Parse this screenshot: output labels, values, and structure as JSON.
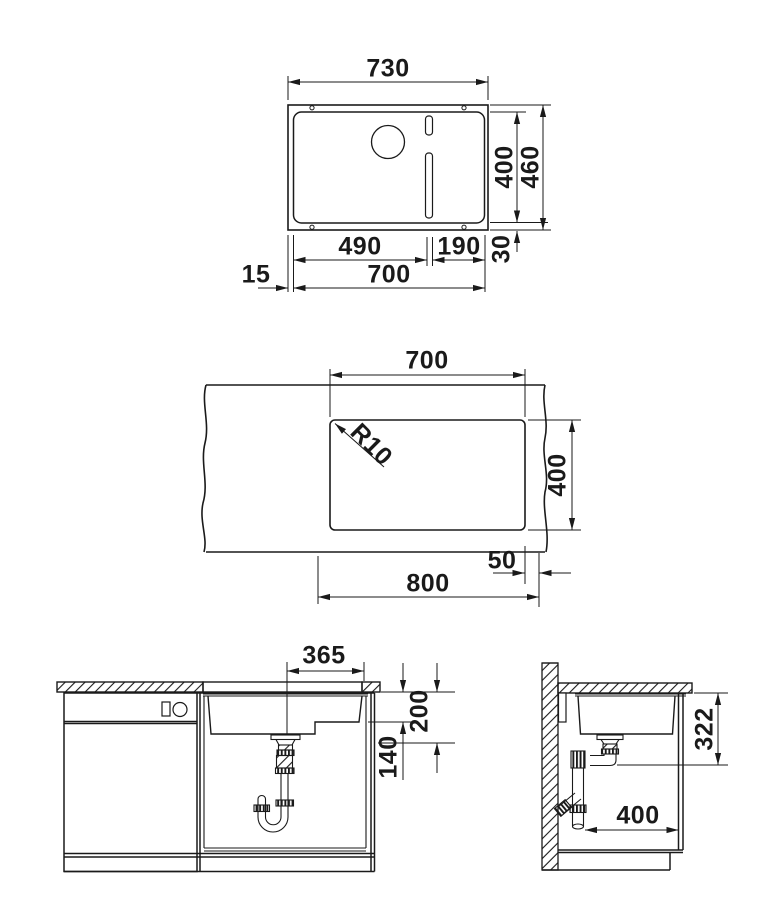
{
  "title": "Sink installation technical drawing",
  "colors": {
    "line": "#1a1a1a",
    "background": "#ffffff"
  },
  "labels": {
    "top_view": {
      "width_730": "730",
      "depth_400": "400",
      "depth_460": "460",
      "edge_30": "30",
      "main_bowl_490": "490",
      "shelf_190": "190",
      "inner_700": "700",
      "edge_15": "15"
    },
    "cutout_view": {
      "width_700": "700",
      "radius_r10": "R10",
      "depth_400": "400",
      "cabinet_800": "800",
      "edge_50": "50"
    },
    "front_view": {
      "drain_365": "365",
      "depth_200": "200",
      "depth_140": "140"
    },
    "side_view": {
      "depth_322": "322",
      "clearance_400": "400"
    }
  }
}
